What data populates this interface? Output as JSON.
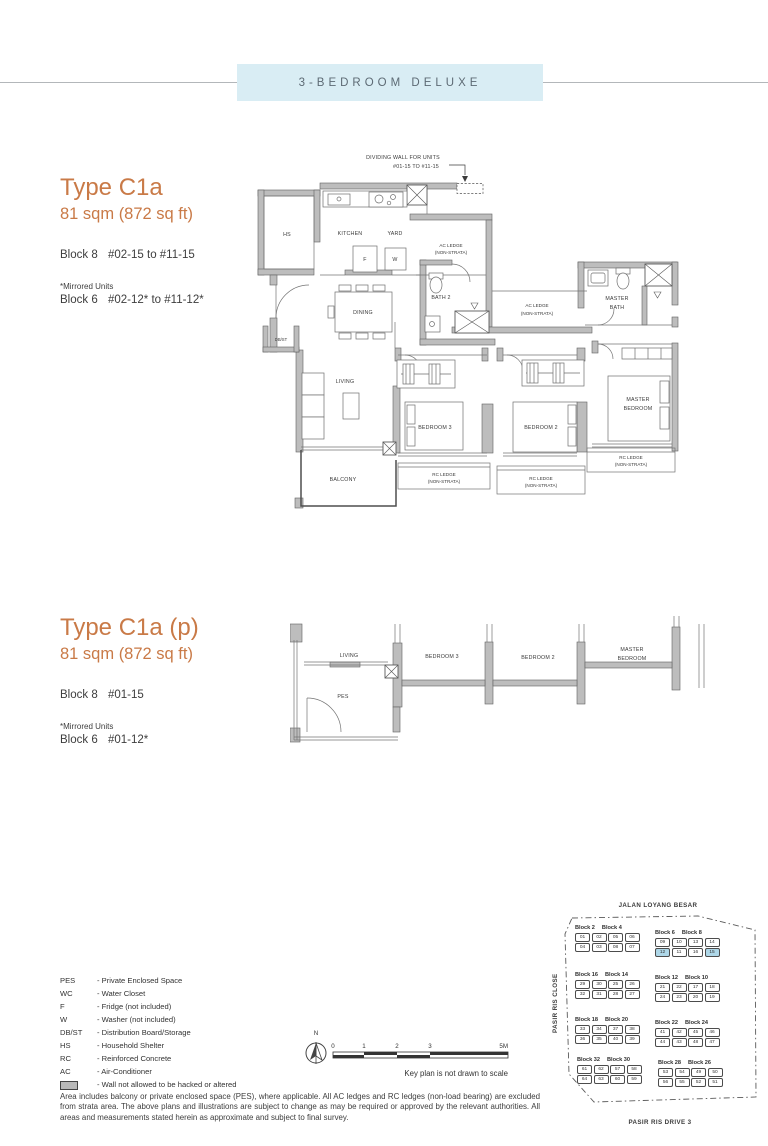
{
  "header": {
    "title": "3-BEDROOM DELUXE"
  },
  "plan1": {
    "title": "Type C1a",
    "area": "81 sqm (872 sq ft)",
    "block1": "Block 8",
    "block1_units": "#02-15 to #11-15",
    "mirrored_note": "*Mirrored Units",
    "block2": "Block 6",
    "block2_units": "#02-12* to #11-12*",
    "annotation1": "DIVIDING WALL FOR UNITS",
    "annotation2": "#01-15 TO #11-15",
    "labels": {
      "hs": "HS",
      "kitchen": "KITCHEN",
      "yard": "YARD",
      "f": "F",
      "w": "W",
      "ac_l1": "AC LEDGE",
      "ac_l2": "(NON-STRATA)",
      "bath2": "BATH 2",
      "dining": "DINING",
      "dbst": "DB/ST",
      "master_bath_l1": "MASTER",
      "master_bath_l2": "BATH",
      "living": "LIVING",
      "balcony": "BALCONY",
      "bedroom3": "BEDROOM 3",
      "bedroom2": "BEDROOM 2",
      "master_bed_l1": "MASTER",
      "master_bed_l2": "BEDROOM",
      "rc_l1": "RC LEDGE",
      "rc_l2": "(NON-STRATA)"
    }
  },
  "plan2": {
    "title": "Type C1a (p)",
    "area": "81 sqm (872 sq ft)",
    "block1": "Block 8",
    "block1_units": "#01-15",
    "mirrored_note": "*Mirrored Units",
    "block2": "Block 6",
    "block2_units": "#01-12*",
    "labels": {
      "living": "LIVING",
      "pes": "PES",
      "bedroom3": "BEDROOM 3",
      "bedroom2": "BEDROOM 2",
      "master_bed_l1": "MASTER",
      "master_bed_l2": "BEDROOM"
    }
  },
  "legend": {
    "items": [
      {
        "abbr": "PES",
        "desc": "- Private Enclosed Space"
      },
      {
        "abbr": "WC",
        "desc": "- Water Closet"
      },
      {
        "abbr": "F",
        "desc": "- Fridge (not included)"
      },
      {
        "abbr": "W",
        "desc": "- Washer (not included)"
      },
      {
        "abbr": "DB/ST",
        "desc": "- Distribution Board/Storage"
      },
      {
        "abbr": "HS",
        "desc": "- Household Shelter"
      },
      {
        "abbr": "RC",
        "desc": "- Reinforced Concrete"
      },
      {
        "abbr": "AC",
        "desc": "- Air-Conditioner"
      },
      {
        "abbr": "",
        "desc": "- Wall not allowed to be hacked or altered",
        "symbol": "wall"
      }
    ]
  },
  "scale_bar": {
    "north_label": "N",
    "ticks": [
      "0",
      "1",
      "2",
      "3",
      "5M"
    ],
    "note": "Key plan is not drawn to scale"
  },
  "key_plan": {
    "road_top": "JALAN LOYANG BESAR",
    "road_left": "PASIR RIS CLOSE",
    "road_bottom": "PASIR RIS DRIVE 3",
    "highlight_color": "#aed7e8",
    "clusters": [
      {
        "blocks": [
          "Block 2",
          "Block 4"
        ],
        "row1": [
          "01",
          "02",
          "05",
          "06"
        ],
        "row2": [
          "04",
          "03",
          "08",
          "07"
        ],
        "highlight": []
      },
      {
        "blocks": [
          "Block 6",
          "Block 8"
        ],
        "row1": [
          "09",
          "10",
          "13",
          "14"
        ],
        "row2": [
          "12",
          "11",
          "16",
          "15"
        ],
        "highlight": [
          "12",
          "15"
        ]
      },
      {
        "blocks": [
          "Block 16",
          "Block 14"
        ],
        "row1": [
          "29",
          "30",
          "25",
          "26"
        ],
        "row2": [
          "32",
          "31",
          "28",
          "27"
        ],
        "highlight": []
      },
      {
        "blocks": [
          "Block 12",
          "Block 10"
        ],
        "row1": [
          "21",
          "22",
          "17",
          "18"
        ],
        "row2": [
          "24",
          "23",
          "20",
          "19"
        ],
        "highlight": []
      },
      {
        "blocks": [
          "Block 18",
          "Block 20"
        ],
        "row1": [
          "33",
          "34",
          "37",
          "38"
        ],
        "row2": [
          "36",
          "35",
          "40",
          "39"
        ],
        "highlight": []
      },
      {
        "blocks": [
          "Block 22",
          "Block 24"
        ],
        "row1": [
          "41",
          "42",
          "45",
          "46"
        ],
        "row2": [
          "44",
          "43",
          "48",
          "47"
        ],
        "highlight": []
      },
      {
        "blocks": [
          "Block 32",
          "Block 30"
        ],
        "row1": [
          "61",
          "62",
          "57",
          "58"
        ],
        "row2": [
          "64",
          "63",
          "60",
          "59"
        ],
        "highlight": []
      },
      {
        "blocks": [
          "Block 28",
          "Block 26"
        ],
        "row1": [
          "53",
          "54",
          "49",
          "50"
        ],
        "row2": [
          "56",
          "55",
          "52",
          "51"
        ],
        "highlight": []
      }
    ]
  },
  "disclaimer": "Area includes balcony or private enclosed space (PES), where applicable. All AC ledges and RC ledges (non-load bearing) are excluded from strata area. The above plans and illustrations are subject to change as may be required or approved by the relevant authorities. All areas and measurements stated herein as approximate and subject to final survey."
}
